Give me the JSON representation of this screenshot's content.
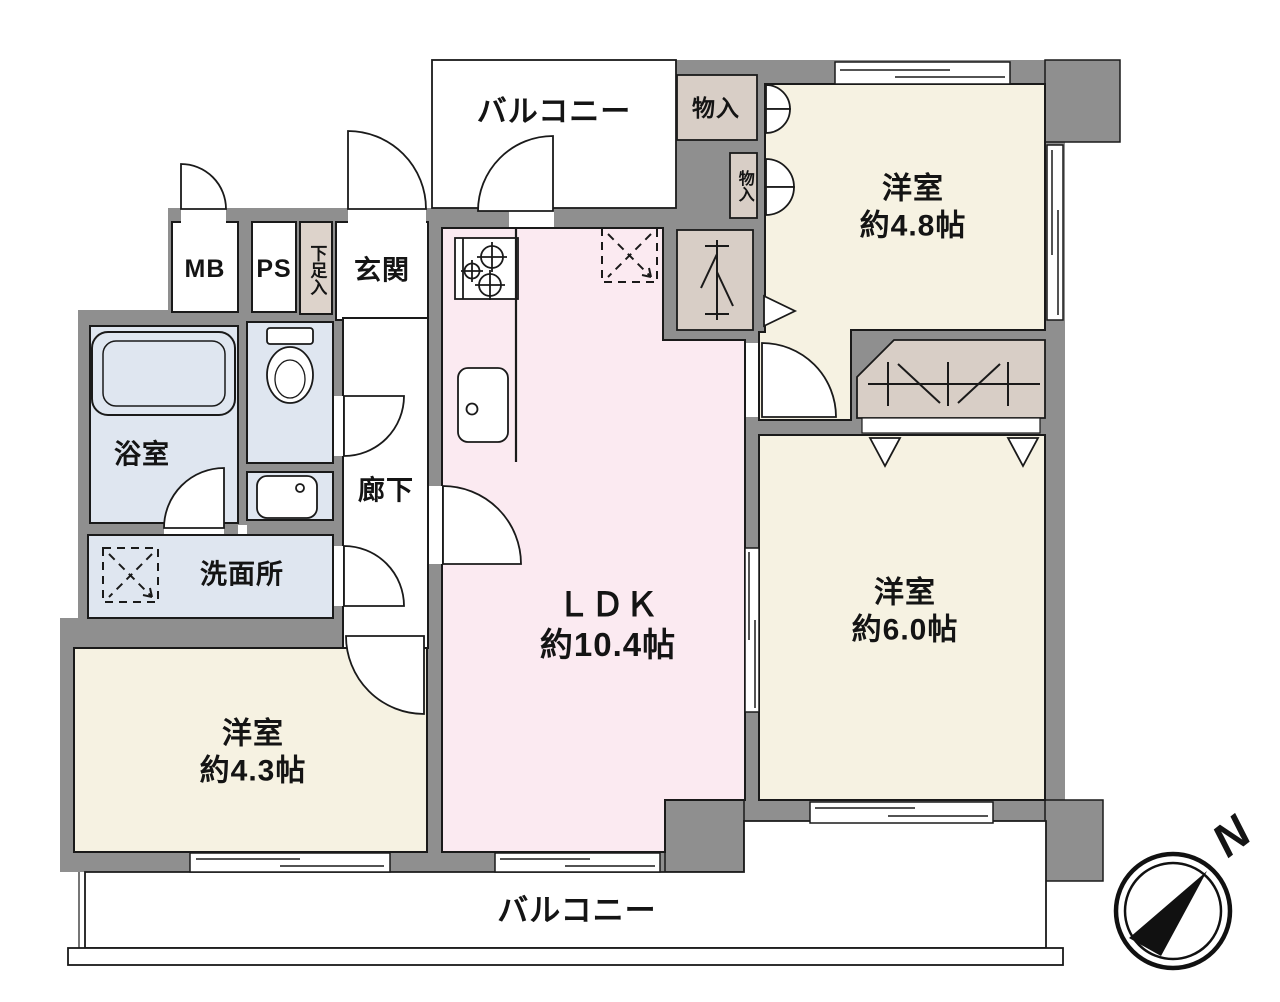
{
  "title": "マンション間取り図",
  "colors": {
    "wall": "#8f8f8f",
    "line": "#1a1a1a",
    "room_cream": "#f6f2e2",
    "ldk_pink": "#fbeaf1",
    "wet_blue": "#dfe6f0",
    "closet_tan": "#d8cec6",
    "white": "#ffffff"
  },
  "balconies": {
    "top": "バルコニー",
    "bottom": "バルコニー"
  },
  "rooms": {
    "western_room_48": {
      "name": "洋室",
      "size": "約4.8帖"
    },
    "western_room_60": {
      "name": "洋室",
      "size": "約6.0帖"
    },
    "western_room_43": {
      "name": "洋室",
      "size": "約4.3帖"
    },
    "ldk": {
      "name": "ＬＤＫ",
      "size": "約10.4帖"
    },
    "bathroom": "浴室",
    "washroom": "洗面所",
    "corridor": "廊下",
    "entrance": "玄関",
    "meter_box": "MB",
    "pipe_space": "PS",
    "shoe_box": "下足入",
    "storage_1": "物入",
    "storage_2": "物入"
  },
  "compass": {
    "label": "N"
  }
}
